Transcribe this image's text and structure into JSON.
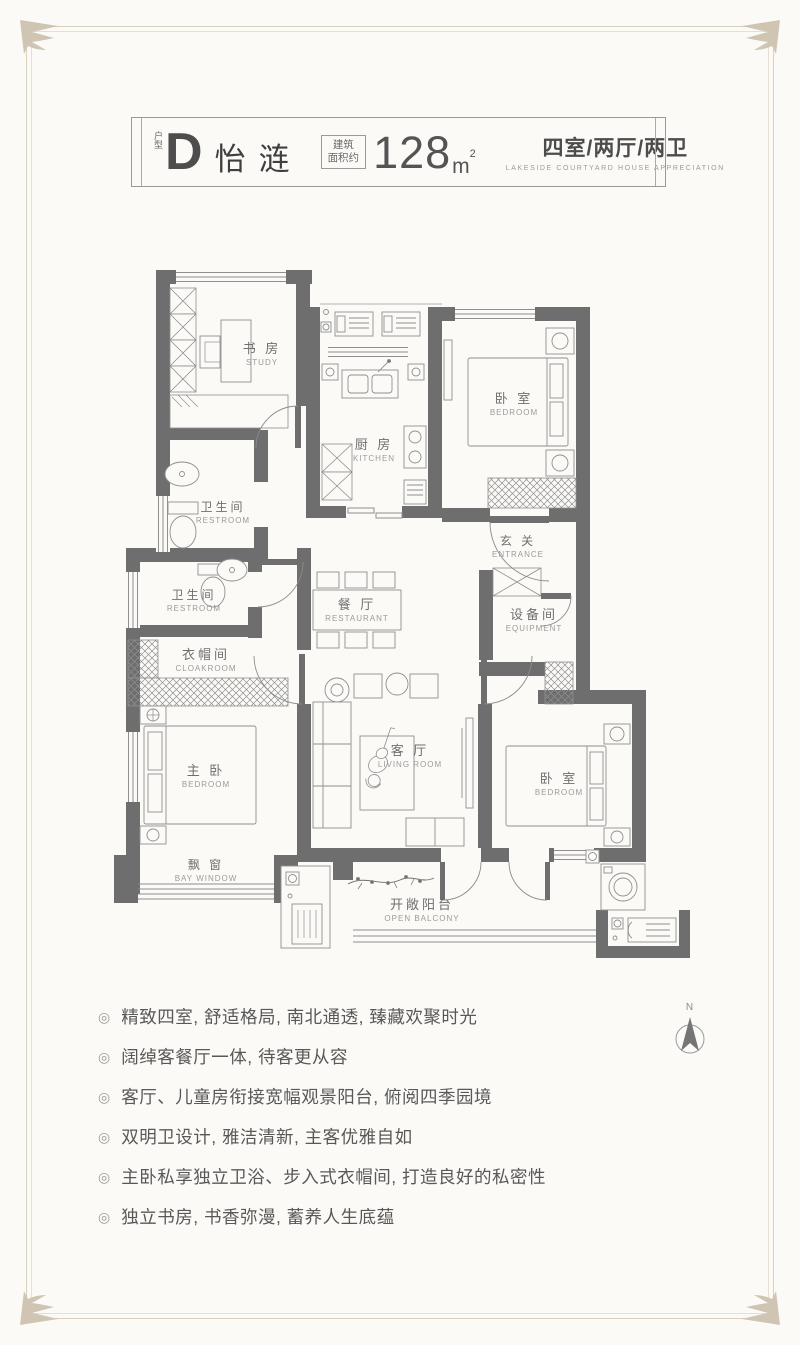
{
  "header": {
    "type_label": "户型",
    "type_letter": "D",
    "type_name": "怡涟",
    "area_label_line1": "建筑",
    "area_label_line2": "面积约",
    "area_value": "128",
    "area_unit": "m",
    "area_sup": "2",
    "layout": "四室/两厅/两卫",
    "layout_sub": "LAKESIDE COURTYARD HOUSE APPRECIATION"
  },
  "floorplan": {
    "compass_label": "N",
    "rooms": {
      "study": {
        "cn": "书 房",
        "en": "STUDY"
      },
      "kitchen": {
        "cn": "厨 房",
        "en": "KITCHEN"
      },
      "bedroom_n": {
        "cn": "卧 室",
        "en": "BEDROOM"
      },
      "entrance": {
        "cn": "玄 关",
        "en": "ENTRANCE"
      },
      "restroom1": {
        "cn": "卫生间",
        "en": "RESTROOM"
      },
      "restroom2": {
        "cn": "卫生间",
        "en": "RESTROOM"
      },
      "cloakroom": {
        "cn": "衣帽间",
        "en": "CLOAKROOM"
      },
      "dining": {
        "cn": "餐 厅",
        "en": "RESTAURANT"
      },
      "equipment": {
        "cn": "设备间",
        "en": "EQUIPMENT"
      },
      "master": {
        "cn": "主 卧",
        "en": "BEDROOM"
      },
      "living": {
        "cn": "客 厅",
        "en": "LIVING ROOM"
      },
      "bedroom_e": {
        "cn": "卧 室",
        "en": "BEDROOM"
      },
      "bay_window": {
        "cn": "飘 窗",
        "en": "BAY WINDOW"
      },
      "balcony": {
        "cn": "开敞阳台",
        "en": "OPEN BALCONY"
      }
    }
  },
  "features": {
    "bullet": "◎",
    "items": [
      "精致四室, 舒适格局, 南北通透, 臻藏欢聚时光",
      "阔绰客餐厅一体, 待客更从容",
      "客厅、儿童房衔接宽幅观景阳台, 俯阅四季园境",
      "双明卫设计, 雅洁清新, 主客优雅自如",
      "主卧私享独立卫浴、步入式衣帽间, 打造良好的私密性",
      "独立书房, 书香弥漫, 蓄养人生底蕴"
    ]
  },
  "colors": {
    "wall": "#6e6e6e",
    "thin_line": "#8f8f8f",
    "frame": "#d8cfc0",
    "text": "#585858"
  }
}
